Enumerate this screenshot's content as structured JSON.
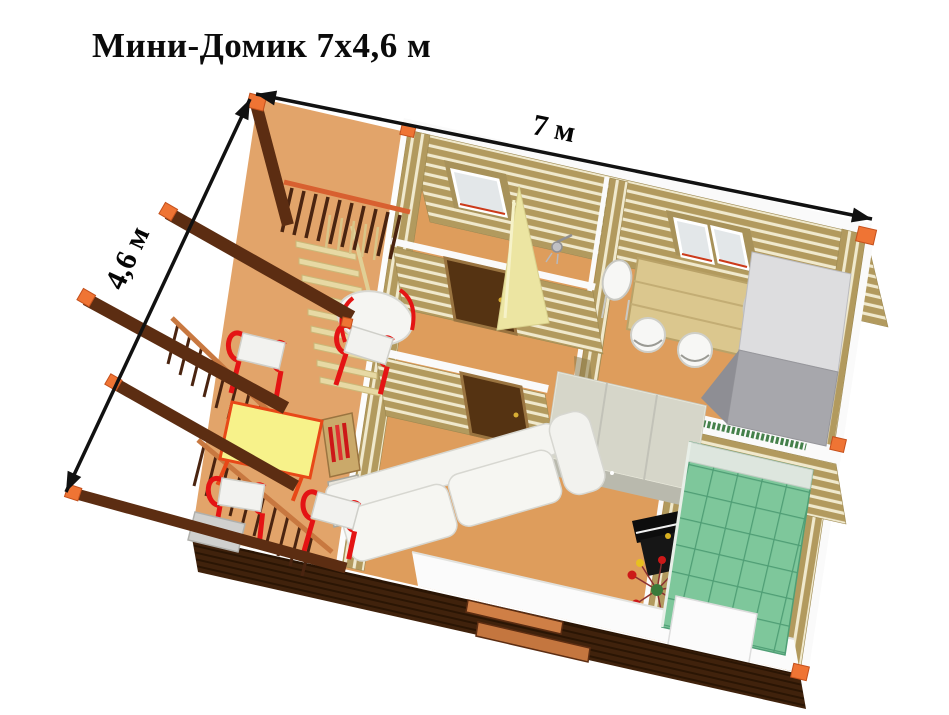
{
  "title": "Мини-Домик 7x4,6 м",
  "dimensions": {
    "width": "7 м",
    "depth": "4,6 м"
  },
  "colors": {
    "wall_plank": "#b29a5e",
    "plank_gap": "#f0e9cd",
    "interior_floor": "#de9d5c",
    "terrace_floor": "#e2a46a",
    "beam_dark": "#5c2d12",
    "front_wall_dark": "#40220c",
    "accent_orange": "#ef7434",
    "chair_red": "#e41414",
    "table_yellow": "#f7f28a",
    "bed_green": "#7ec79b",
    "fridge_gray": "#a7a7ac",
    "door_brown": "#553312",
    "arrow_black": "#111111",
    "white_trim": "#fafafa"
  }
}
